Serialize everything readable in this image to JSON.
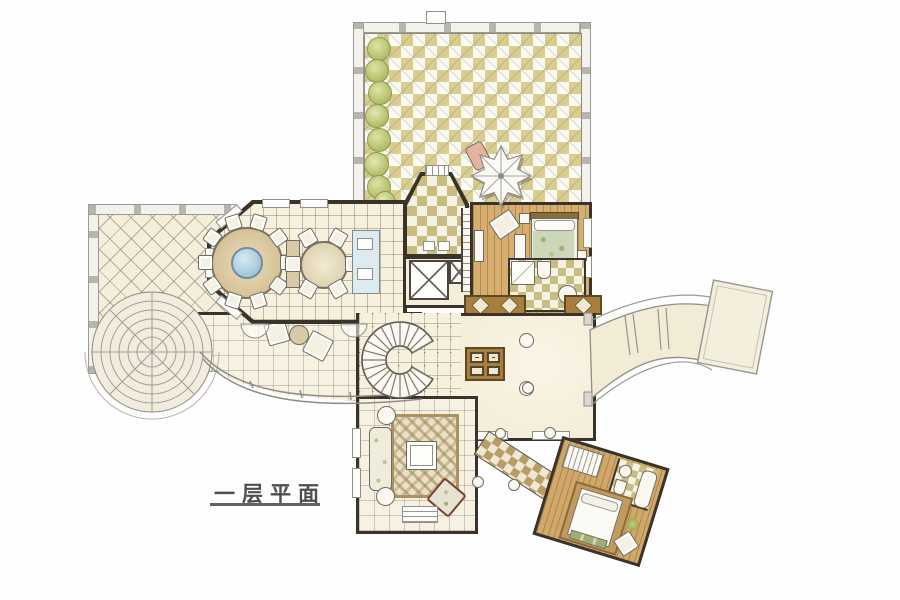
{
  "title": {
    "label": "一层平面"
  },
  "palette": {
    "paper": "#fefefe",
    "terrace_tan": "#d9cd92",
    "terrace_white": "#fbfaf2",
    "floor_cream": "#f5efdc",
    "wall_dark": "#3a332b",
    "wood_tan": "#d4ab6c",
    "table_blue": "#aacbdd",
    "island_blue": "#dcebf0",
    "bush_green": "#bcc67a",
    "rail_gray": "#a3a29b",
    "band_brown": "#a87f3e",
    "armchair_red": "#7a4038",
    "bedding_floral": "#ccd6b8"
  }
}
